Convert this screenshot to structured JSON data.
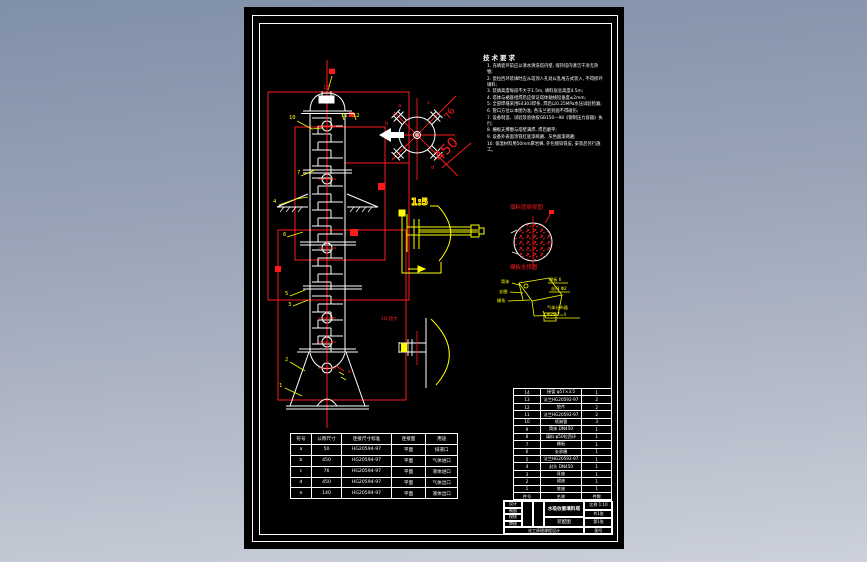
{
  "drawing": {
    "notes": {
      "title": "技术要求",
      "lines": [
        "1. 充填瓷环前应以清水清洗塔内壁, 保持塔内清洁干净无杂物;",
        "2. 瓷拉西环装填时应从塔顶人孔处以乱堆方式装入, 不得损坏填料;",
        "3. 装填高度每段不大于1.5m, 填料层总高度4.5m;",
        "4. 塔体与裙座组焊后应保证塔体轴线铅垂度≤2mm;",
        "5. 全部焊缝采用E4303焊条, 焊后以0.25MPa水压试验检漏;",
        "6. 管口方位以本图为准, 各法兰密封面不得碰伤;",
        "7. 设备制造、试验及验收按GB150—98《钢制压力容器》执行;",
        "8. 栅板支撑圈与塔壁满焊, 焊后磨平;",
        "9. 设备外表面涂铁红底漆两遍、灰色面漆两遍;",
        "10. 保温材料用50mm厚岩棉, 外包镀锌铁皮, 安装后另行施工。"
      ]
    },
    "views": {
      "top_view": {
        "dim_450": "450",
        "dim_76": "76"
      },
      "detail_1_5": {
        "scale_label": "1:5"
      },
      "detail_d": {
        "label": "1D 放大"
      },
      "packing_view": {
        "title": "填料层俯视图"
      },
      "support_view": {
        "title": "栅板支撑图",
        "labels_left": [
          "筒体",
          "支圈",
          "栅条"
        ],
        "labels_right": [
          "棚板 Ⅱ",
          "丝网 Φ2"
        ],
        "labels_bottom": [
          "气体分布器",
          "Φ25  Z=4"
        ]
      }
    },
    "callouts": [
      "14",
      "13",
      "12",
      "11",
      "10",
      "7",
      "6",
      "5",
      "4",
      "3",
      "2",
      "1"
    ],
    "nozzle_letters": [
      "a",
      "b",
      "c",
      "d",
      "e"
    ],
    "nozzle_table": {
      "headers": [
        "符号",
        "公称尺寸",
        "连接尺寸标准",
        "连接面",
        "用途"
      ],
      "rows": [
        [
          "a",
          "50",
          "HG20594-97",
          "平面",
          "排液口"
        ],
        [
          "b",
          "450",
          "HG20594-97",
          "平面",
          "气体进口"
        ],
        [
          "c",
          "76",
          "HG20594-97",
          "平面",
          "液体进口"
        ],
        [
          "d",
          "450",
          "HG20594-97",
          "平面",
          "气体出口"
        ],
        [
          "e",
          "140",
          "HG20594-97",
          "平面",
          "液体出口"
        ]
      ]
    },
    "bom_table": {
      "rows": [
        [
          "14",
          "接管 φ57×3.5",
          "1"
        ],
        [
          "13",
          "法兰HG20592-97",
          "2"
        ],
        [
          "12",
          "垫片",
          "2"
        ],
        [
          "11",
          "法兰HG20592-97",
          "2"
        ],
        [
          "10",
          "喷淋管",
          "3"
        ],
        [
          "9",
          "筒体 DN450",
          "1"
        ],
        [
          "8",
          "填料 φ50拉西环",
          "1"
        ],
        [
          "7",
          "栅板",
          "1"
        ],
        [
          "6",
          "支承圈",
          "1"
        ],
        [
          "5",
          "法兰HG20592-97",
          "1"
        ],
        [
          "4",
          "封头 DN450",
          "1"
        ],
        [
          "3",
          "耳座",
          "1"
        ],
        [
          "2",
          "裙座",
          "1"
        ],
        [
          "1",
          "底座",
          "1"
        ],
        [
          "件号",
          "名称",
          "件数"
        ]
      ]
    },
    "title_block": {
      "roles": [
        "设计",
        "制图",
        "校核",
        "审核"
      ],
      "project": "化工原理课程设计",
      "title_line1": "水吸收氨填料塔",
      "title_line2": "装配图",
      "scale": "比例 1:10",
      "sheets": "共1张",
      "sheet_no": "第1张",
      "drawing_no": "图号"
    },
    "colors": {
      "line": "#ffffff",
      "accent_red": "#ff1a1a",
      "accent_yellow": "#ffff00",
      "sheet_bg": "#000000"
    }
  }
}
